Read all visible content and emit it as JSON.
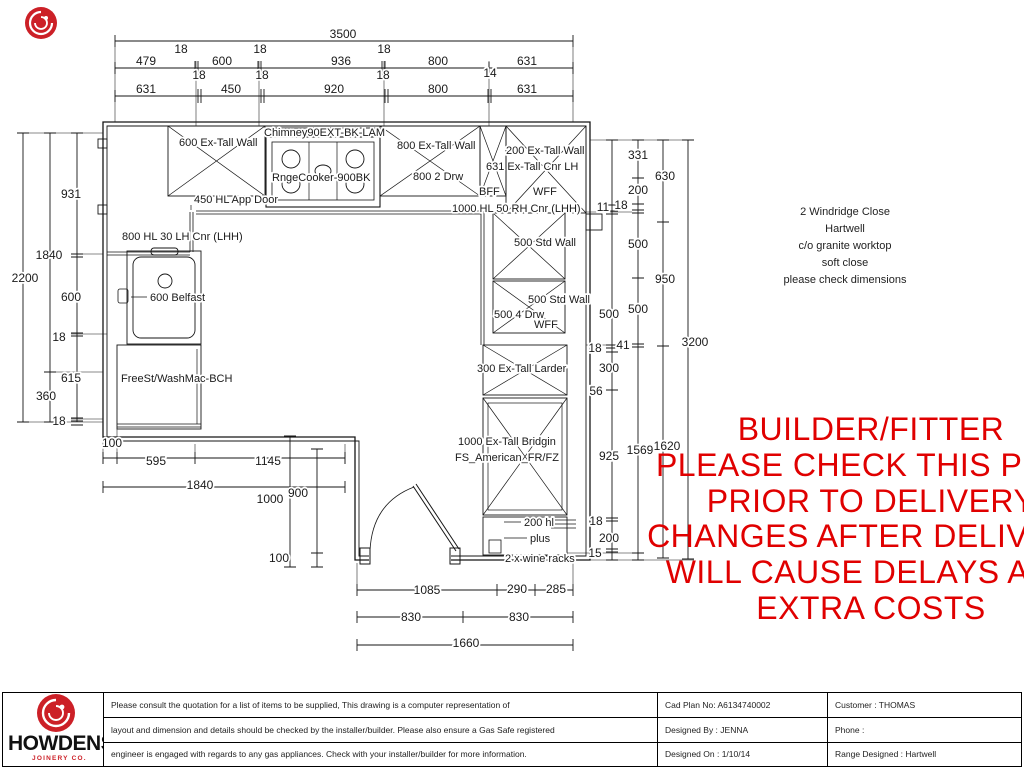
{
  "colors": {
    "warning_red": "#e00000",
    "logo_red": "#cc2027",
    "line_black": "#161616"
  },
  "address_block": {
    "lines": [
      "2 Windridge Close",
      "Hartwell",
      "c/o granite worktop",
      "soft close",
      "please check dimensions"
    ]
  },
  "warning": {
    "lines": [
      "BUILDER/FITTER",
      "PLEASE CHECK THIS PLAN",
      "PRIOR TO DELIVERY",
      "CHANGES AFTER DELIVERY",
      "WILL CAUSE DELAYS AND",
      "EXTRA COSTS"
    ]
  },
  "title_block": {
    "brand": "HOWDENS",
    "brand_sub": "JOINERY CO.",
    "disclaimer": [
      "Please consult the quotation for a list of items to be supplied, This drawing is a computer representation of",
      "layout and dimension and details should be checked by the installer/builder. Please also ensure a Gas Safe registered",
      "engineer is engaged with regards to any gas appliances. Check with your installer/builder for more information."
    ],
    "fields": {
      "cad_plan_no": "Cad Plan No: A6134740002",
      "customer": "Customer : THOMAS",
      "designed_by": "Designed By : JENNA",
      "phone": "Phone :",
      "designed_on": "Designed On : 1/10/14",
      "range_designed": "Range Designed : Hartwell"
    }
  },
  "plan_labels": [
    {
      "t": "600 Ex-Tall Wall",
      "x": 179,
      "y": 146,
      "a": "start"
    },
    {
      "t": "Chimney90EXT-BK-LAM",
      "x": 264,
      "y": 136,
      "a": "start"
    },
    {
      "t": "RngeCooker-900BK",
      "x": 272,
      "y": 181,
      "a": "start"
    },
    {
      "t": "450 HL App Door",
      "x": 194,
      "y": 203,
      "a": "start"
    },
    {
      "t": "800 Ex-Tall Wall",
      "x": 397,
      "y": 149,
      "a": "start"
    },
    {
      "t": "200 Ex-Tall Wall",
      "x": 506,
      "y": 154,
      "a": "start"
    },
    {
      "t": "631 Ex-Tall Cnr LH",
      "x": 486,
      "y": 170,
      "a": "start"
    },
    {
      "t": "800 2 Drw",
      "x": 413,
      "y": 180,
      "a": "start"
    },
    {
      "t": "BFF",
      "x": 479,
      "y": 195,
      "a": "start"
    },
    {
      "t": "WFF",
      "x": 533,
      "y": 195,
      "a": "start"
    },
    {
      "t": "1000 HL 50 RH Cnr (LHH)",
      "x": 452,
      "y": 212,
      "a": "start"
    },
    {
      "t": "800 HL 30 LH Cnr (LHH)",
      "x": 122,
      "y": 240,
      "a": "start"
    },
    {
      "t": "600 Belfast",
      "x": 150,
      "y": 301,
      "a": "start"
    },
    {
      "t": "FreeSt/WashMac-BCH",
      "x": 121,
      "y": 382,
      "a": "start"
    },
    {
      "t": "500 Std Wall",
      "x": 514,
      "y": 246,
      "a": "start"
    },
    {
      "t": "500 Std Wall",
      "x": 528,
      "y": 303,
      "a": "start"
    },
    {
      "t": "500 4 Drw",
      "x": 494,
      "y": 318,
      "a": "start"
    },
    {
      "t": "WFF",
      "x": 534,
      "y": 328,
      "a": "start"
    },
    {
      "t": "300 Ex-Tall Larder",
      "x": 477,
      "y": 372,
      "a": "start"
    },
    {
      "t": "1000 Ex-Tall Bridgin",
      "x": 458,
      "y": 445,
      "a": "start"
    },
    {
      "t": "FS_American_FR/FZ",
      "x": 455,
      "y": 461,
      "a": "start"
    },
    {
      "t": "200 hl",
      "x": 524,
      "y": 526,
      "a": "start"
    },
    {
      "t": "plus",
      "x": 530,
      "y": 542,
      "a": "start"
    },
    {
      "t": "2 x wine racks",
      "x": 505,
      "y": 562,
      "a": "start"
    }
  ],
  "dim_labels": [
    {
      "t": "3500",
      "x": 343,
      "y": 38
    },
    {
      "t": "18",
      "x": 181,
      "y": 53
    },
    {
      "t": "18",
      "x": 260,
      "y": 53
    },
    {
      "t": "18",
      "x": 384,
      "y": 53
    },
    {
      "t": "479",
      "x": 146,
      "y": 65
    },
    {
      "t": "600",
      "x": 222,
      "y": 65
    },
    {
      "t": "936",
      "x": 341,
      "y": 65
    },
    {
      "t": "800",
      "x": 438,
      "y": 65
    },
    {
      "t": "631",
      "x": 527,
      "y": 65
    },
    {
      "t": "18",
      "x": 199,
      "y": 79
    },
    {
      "t": "18",
      "x": 262,
      "y": 79
    },
    {
      "t": "18",
      "x": 383,
      "y": 79
    },
    {
      "t": "14",
      "x": 490,
      "y": 77
    },
    {
      "t": "631",
      "x": 146,
      "y": 93
    },
    {
      "t": "450",
      "x": 231,
      "y": 93
    },
    {
      "t": "920",
      "x": 334,
      "y": 93
    },
    {
      "t": "800",
      "x": 438,
      "y": 93
    },
    {
      "t": "631",
      "x": 527,
      "y": 93
    },
    {
      "t": "2200",
      "x": 25,
      "y": 282
    },
    {
      "t": "931",
      "x": 71,
      "y": 198
    },
    {
      "t": "1840",
      "x": 49,
      "y": 259
    },
    {
      "t": "600",
      "x": 71,
      "y": 301
    },
    {
      "t": "18",
      "x": 59,
      "y": 341
    },
    {
      "t": "615",
      "x": 71,
      "y": 382
    },
    {
      "t": "360",
      "x": 46,
      "y": 400
    },
    {
      "t": "18",
      "x": 59,
      "y": 425
    },
    {
      "t": "331",
      "x": 638,
      "y": 159
    },
    {
      "t": "630",
      "x": 665,
      "y": 180
    },
    {
      "t": "200",
      "x": 638,
      "y": 194
    },
    {
      "t": "11",
      "x": 603,
      "y": 211
    },
    {
      "t": "18",
      "x": 621,
      "y": 209
    },
    {
      "t": "500",
      "x": 638,
      "y": 248
    },
    {
      "t": "950",
      "x": 665,
      "y": 283
    },
    {
      "t": "500",
      "x": 609,
      "y": 318
    },
    {
      "t": "500",
      "x": 638,
      "y": 313
    },
    {
      "t": "18",
      "x": 595,
      "y": 352
    },
    {
      "t": "41",
      "x": 623,
      "y": 349
    },
    {
      "t": "300",
      "x": 609,
      "y": 372
    },
    {
      "t": "56",
      "x": 596,
      "y": 395
    },
    {
      "t": "3200",
      "x": 695,
      "y": 346
    },
    {
      "t": "925",
      "x": 609,
      "y": 460
    },
    {
      "t": "1569",
      "x": 640,
      "y": 454
    },
    {
      "t": "1620",
      "x": 667,
      "y": 450
    },
    {
      "t": "18",
      "x": 596,
      "y": 525
    },
    {
      "t": "200",
      "x": 609,
      "y": 542
    },
    {
      "t": "15",
      "x": 595,
      "y": 557
    },
    {
      "t": "100",
      "x": 112,
      "y": 447
    },
    {
      "t": "595",
      "x": 156,
      "y": 465
    },
    {
      "t": "1145",
      "x": 268,
      "y": 465
    },
    {
      "t": "1840",
      "x": 200,
      "y": 489
    },
    {
      "t": "1000",
      "x": 270,
      "y": 503
    },
    {
      "t": "900",
      "x": 298,
      "y": 497
    },
    {
      "t": "100",
      "x": 279,
      "y": 562
    },
    {
      "t": "1085",
      "x": 427,
      "y": 594
    },
    {
      "t": "290",
      "x": 517,
      "y": 593
    },
    {
      "t": "285",
      "x": 556,
      "y": 593
    },
    {
      "t": "830",
      "x": 411,
      "y": 621
    },
    {
      "t": "830",
      "x": 519,
      "y": 621
    },
    {
      "t": "1660",
      "x": 466,
      "y": 647
    }
  ]
}
